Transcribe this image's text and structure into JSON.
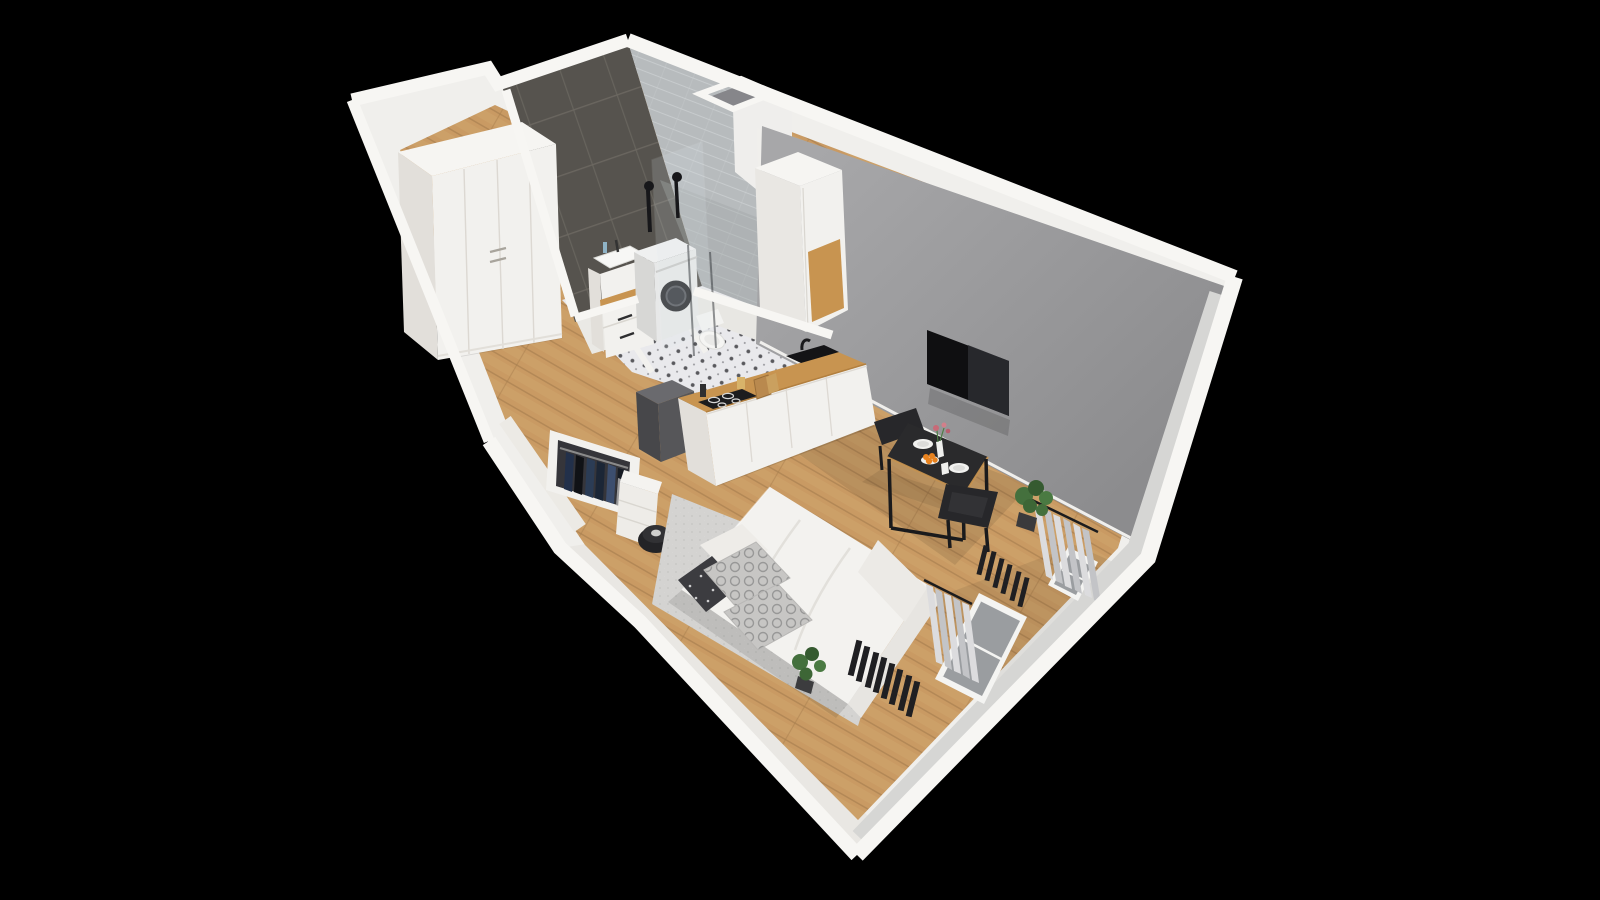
{
  "scene": {
    "type": "isometric-cutaway-floorplan-render",
    "description": "3D dollhouse view of a studio apartment on black background",
    "rooms": [
      "entry-hall",
      "bathroom",
      "kitchen",
      "living-sleeping-area"
    ],
    "furniture": [
      "wardrobe",
      "sink-vanity",
      "washing-machine",
      "toilet",
      "shower",
      "tall-cabinet",
      "kitchen-counter",
      "cooktop",
      "kitchen-sink",
      "tv",
      "dining-table",
      "dining-chairs",
      "bed",
      "pillows",
      "rug",
      "open-closet",
      "pouf",
      "radiators",
      "curtains",
      "windows",
      "plants"
    ]
  },
  "palette": {
    "bg": "#000000",
    "wall_white": "#f0efec",
    "wall_bright": "#f7f6f3",
    "wall_shade_se": "#e4e2de",
    "wall_shade_sw": "#e9e7e3",
    "wall_inner_band": "#d6d6d4",
    "accent_wall": "#98989a",
    "dark_tile": "#56534e",
    "dark_tile_line": "#6b6760",
    "light_tile": "#b7bbbd",
    "light_tile_line": "#caced0",
    "wood_floor": "#c99a63",
    "wood_floor_line": "#aa8050",
    "wood_counter": "#c89450",
    "bath_floor": "#e9e9ec",
    "bath_floor_motif": "#34343a",
    "rug_gray": "#d4d3d1",
    "duvet_white": "#f3f2ef",
    "mattress_shade": "#e7e5e1",
    "pillow_gray": "#c7c6c4",
    "pillow_pattern": "#8f8f8f",
    "pillow_dark": "#3c3c40",
    "tv_black": "#0f0f11",
    "tv_reflection": "#2b2d31",
    "table_black": "#2a2a2c",
    "chair_black": "#27272a",
    "radiator_black": "#1f1f22",
    "curtain_light": "#dcdcde",
    "curtain_dark": "#c3c4c7",
    "window_glass": "#9a9da0",
    "plant_green": "#44703d",
    "plant_green_dark": "#355a30",
    "appliance_white": "#eff0f0",
    "washer_door": "#2f3033",
    "cabinet_white": "#f2f1ee",
    "cabinet_shade": "#e2dfda",
    "cooktop_black": "#1c1c1e",
    "sink_black": "#141416",
    "box_dark": "#565659",
    "pouf_black": "#232326",
    "clothes_navy": "#2b3c55"
  }
}
